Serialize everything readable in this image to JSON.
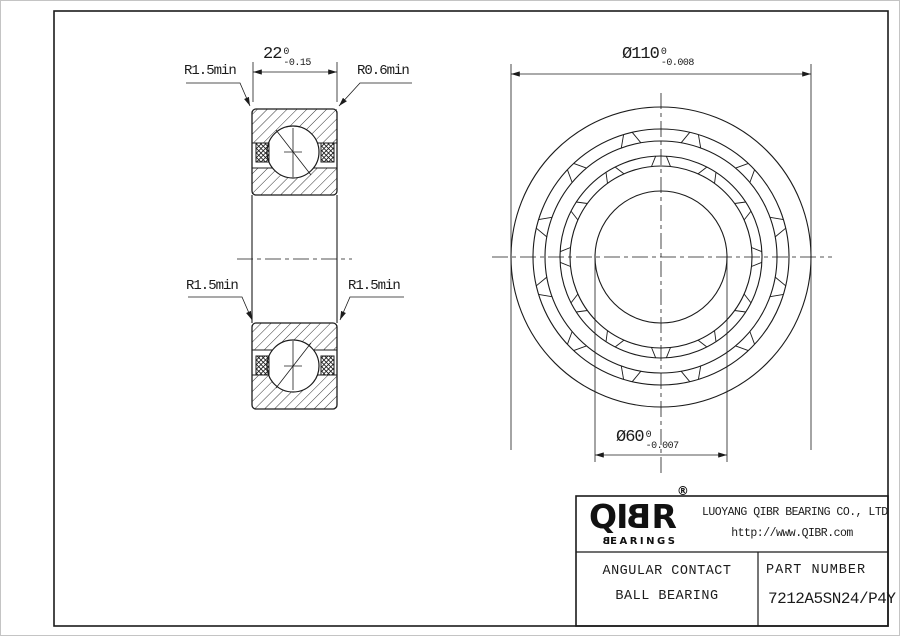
{
  "dimensions": {
    "width": {
      "main": "22",
      "tol_upper": "0",
      "tol_lower": "-0.15"
    },
    "outer_diameter": {
      "main": "Ø110",
      "tol_upper": "0",
      "tol_lower": "-0.008"
    },
    "bore_diameter": {
      "main": "Ø60",
      "tol_upper": "0",
      "tol_lower": "-0.007"
    }
  },
  "annotations": {
    "top_left": "R1.5min",
    "top_right": "R0.6min",
    "mid_left": "R1.5min",
    "mid_right": "R1.5min"
  },
  "title_block": {
    "logo": "QIBR",
    "logo_mark": "®",
    "logo_sub": "BEARINGS",
    "company": "LUOYANG QIBR BEARING CO., LTD",
    "website": "http://www.QIBR.com",
    "product_type_line1": "ANGULAR CONTACT",
    "product_type_line2": "BALL BEARING",
    "part_number_label": "PART NUMBER",
    "part_number": "7212A5SN24/P4Y"
  }
}
